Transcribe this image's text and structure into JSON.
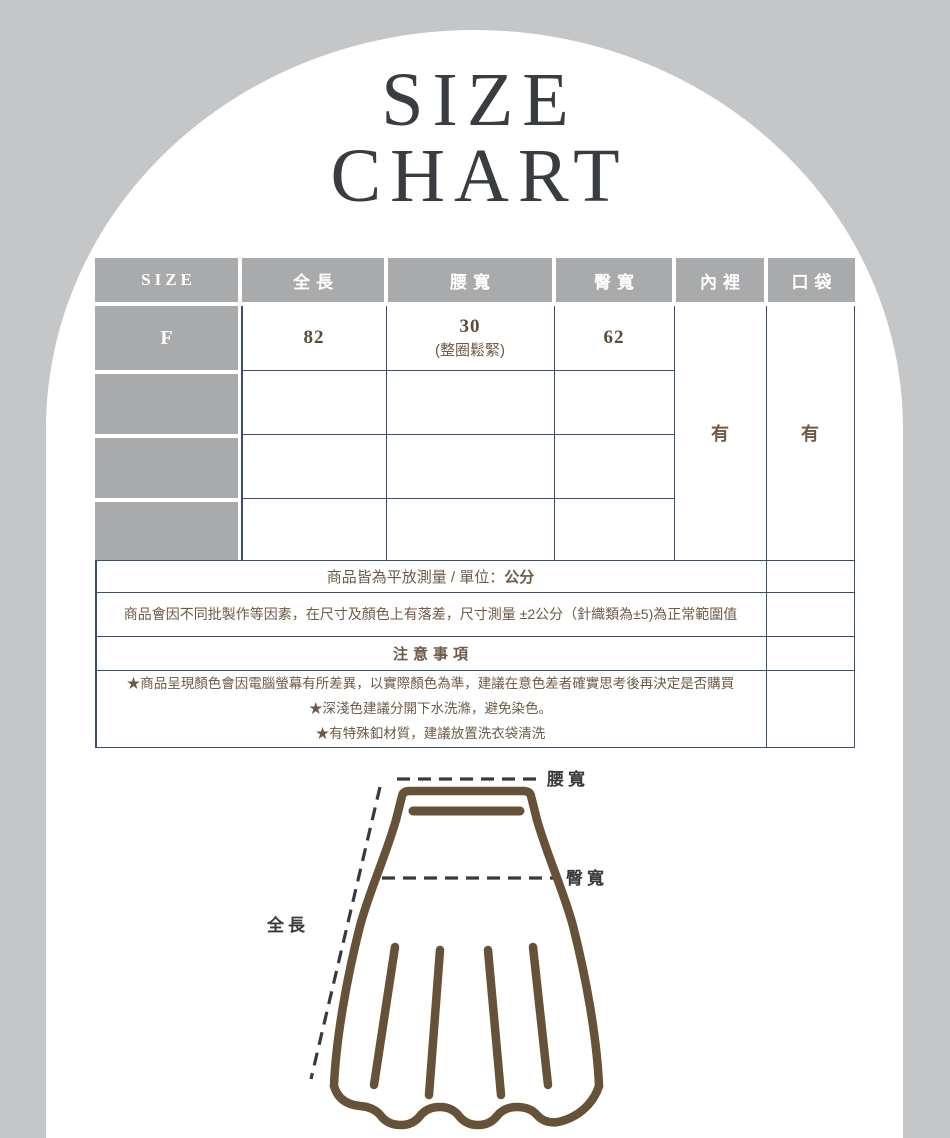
{
  "page": {
    "background_color": "#c5c6c7",
    "arch_color": "#ffffff"
  },
  "title": {
    "line1": "SIZE",
    "line2": "CHART",
    "color": "#393c40"
  },
  "size_table": {
    "headers": [
      "SIZE",
      "全長",
      "腰寬",
      "臀寬",
      "內裡",
      "口袋"
    ],
    "rows": [
      {
        "size": "F",
        "full_length": "82",
        "waist": "30",
        "waist_note": "(整圈鬆緊)",
        "hip": "62"
      },
      {
        "size": "",
        "full_length": "",
        "waist": "",
        "waist_note": "",
        "hip": ""
      },
      {
        "size": "",
        "full_length": "",
        "waist": "",
        "waist_note": "",
        "hip": ""
      },
      {
        "size": "",
        "full_length": "",
        "waist": "",
        "waist_note": "",
        "hip": ""
      }
    ],
    "lining_value": "有",
    "pocket_value": "有",
    "header_bg": "#a9aaab",
    "header_text_color": "#ffffff",
    "border_color": "#3b5068",
    "value_color": "#5d4a37"
  },
  "notes": {
    "measurement_prefix": "商品皆為平放測量 / 單位：",
    "measurement_unit": "公分",
    "tolerance": "商品會因不同批製作等因素，在尺寸及顏色上有落差，尺寸測量 ±2公分（針織類為±5)為正常範圍值",
    "attention_title": "注意事項",
    "attention_items": [
      "★商品呈現顏色會因電腦螢幕有所差異，以實際顏色為準，建議在意色差者確實思考後再決定是否購買",
      "★深淺色建議分開下水洗滌，避免染色。",
      "★有特殊釦材質，建議放置洗衣袋清洗"
    ],
    "text_color": "#6e5a46"
  },
  "diagram": {
    "waist_label": "腰寬",
    "hip_label": "臀寬",
    "length_label": "全長",
    "outline_color": "#665238",
    "label_color": "#3a3a3a"
  },
  "chart_data": {
    "type": "table",
    "columns": [
      "SIZE",
      "全長",
      "腰寬",
      "臀寬",
      "內裡",
      "口袋"
    ],
    "rows": [
      [
        "F",
        "82",
        "30 (整圈鬆緊)",
        "62",
        "有",
        "有"
      ]
    ],
    "unit": "公分"
  }
}
